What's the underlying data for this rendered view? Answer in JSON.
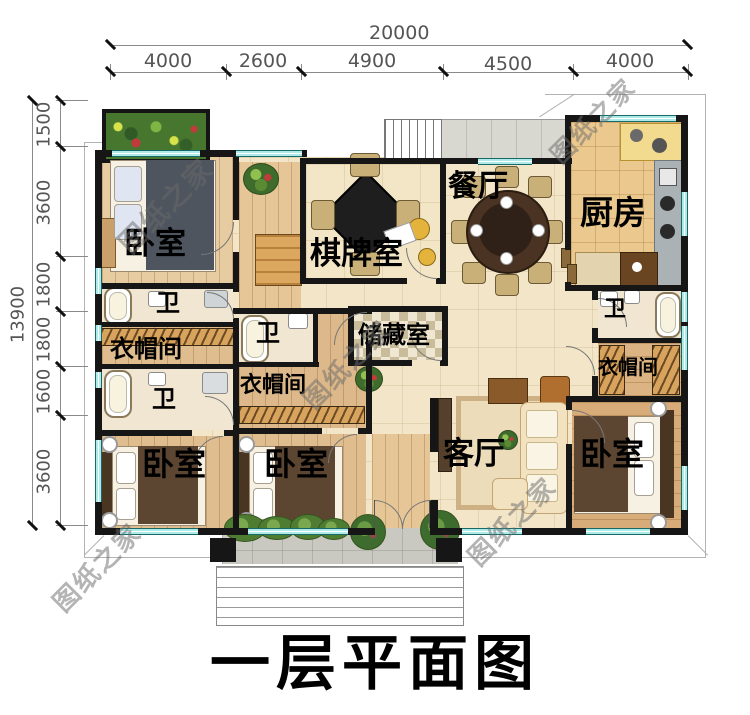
{
  "title": "一层平面图",
  "watermark_text": "图纸之家",
  "dimensions": {
    "top_total": "20000",
    "top_segments": [
      "4000",
      "2600",
      "4900",
      "4500",
      "4000"
    ],
    "left_total": "13900",
    "left_segments": [
      "1500",
      "3600",
      "1800",
      "1800",
      "1600",
      "3600"
    ]
  },
  "rooms": {
    "bedroom_top_left": {
      "label": "卧室"
    },
    "bathroom_1": {
      "label": "卫"
    },
    "cloakroom_1": {
      "label": "衣帽间"
    },
    "bathroom_2": {
      "label": "卫"
    },
    "bedroom_bottom_left_1": {
      "label": "卧室"
    },
    "bathroom_3": {
      "label": "卫"
    },
    "cloakroom_2": {
      "label": "衣帽间"
    },
    "bedroom_bottom_left_2": {
      "label": "卧室"
    },
    "chess_room": {
      "label": "棋牌室"
    },
    "dining_room": {
      "label": "餐厅"
    },
    "kitchen": {
      "label": "厨房"
    },
    "storage_room": {
      "label": "储藏室"
    },
    "living_room": {
      "label": "客厅"
    },
    "bathroom_4": {
      "label": "卫"
    },
    "cloakroom_3": {
      "label": "衣帽间"
    },
    "bedroom_right": {
      "label": "卧室"
    }
  }
}
